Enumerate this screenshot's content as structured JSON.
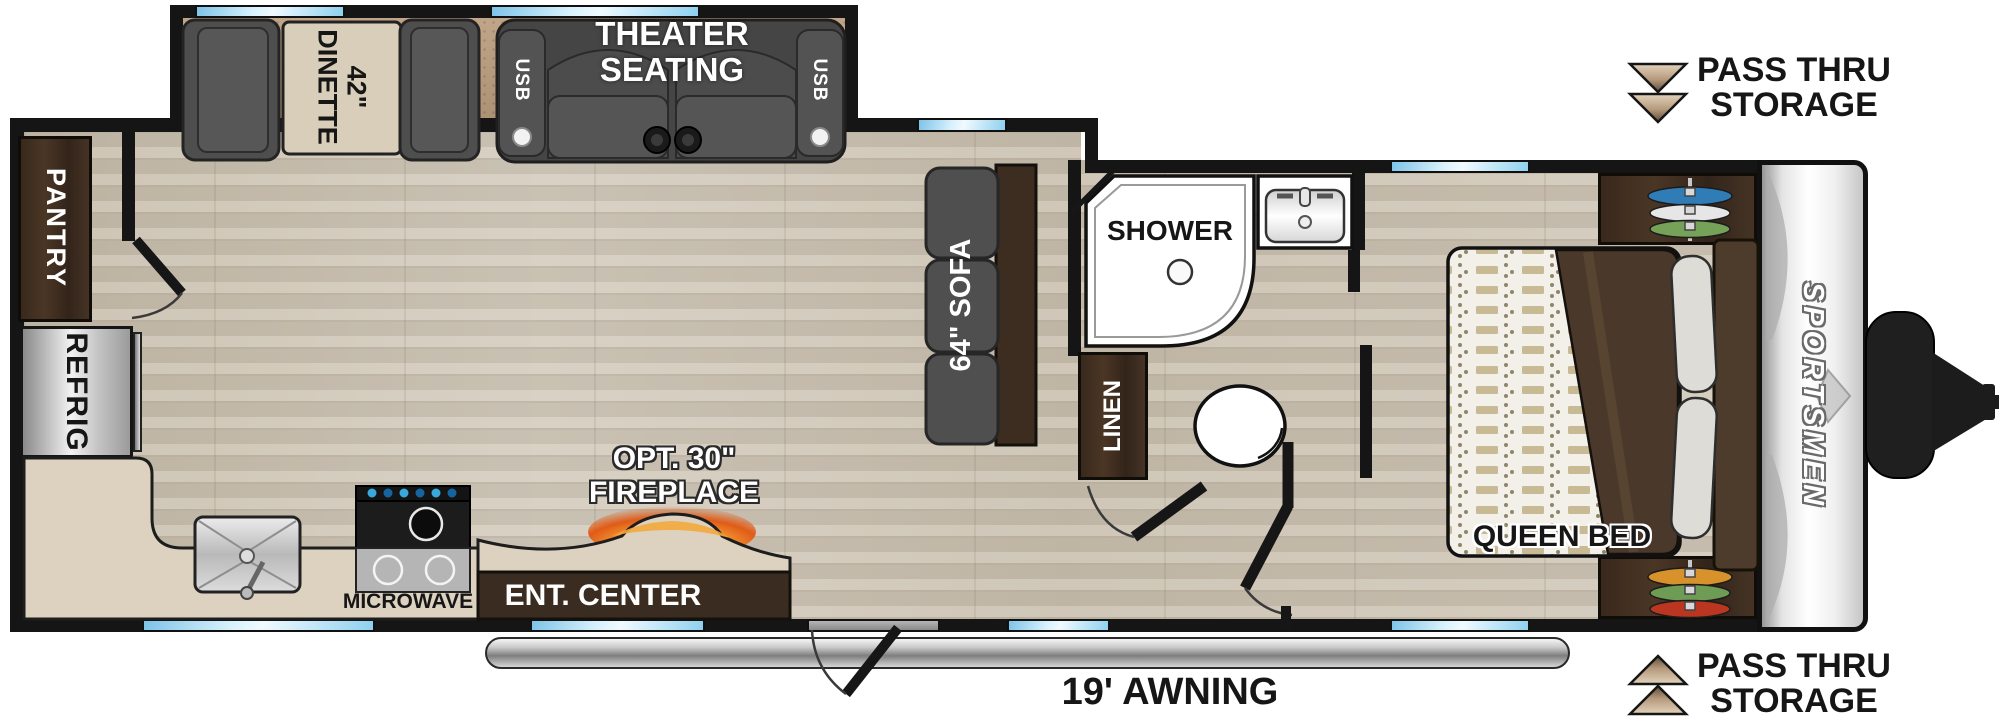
{
  "labels": {
    "dinette": "42\" DINETTE",
    "theater_line1": "THEATER",
    "theater_line2": "SEATING",
    "usb": "USB",
    "pantry": "PANTRY",
    "refrig": "REFRIG",
    "microwave": "MICROWAVE",
    "sofa": "64\" SOFA",
    "shower": "SHOWER",
    "linen": "LINEN",
    "queen_bed": "QUEEN BED",
    "ent_center": "ENT. CENTER",
    "fireplace_line1": "OPT. 30\"",
    "fireplace_line2": "FIREPLACE",
    "awning": "19' AWNING",
    "pass_thru_line1": "PASS THRU",
    "pass_thru_line2": "STORAGE",
    "brand_logo": "SPORTSMEN"
  },
  "icons": {
    "pass_thru_top": "double-chevron-down-icon",
    "pass_thru_bottom": "double-chevron-up-icon",
    "fireplace": "flame-glow-icon",
    "cupholders": "cupholder-circles-icon"
  },
  "colors": {
    "window_glass": "#8ed0ef",
    "wood_floor": "#cdc3b2",
    "slide_floor": "#b79c80",
    "counter": "#ddd2bf",
    "cabinet_dark": "#3a2c20",
    "furniture_gray": "#4e4e4e",
    "fireplace_glow": "#f59b2e",
    "awning_tube": "#9a9a9a",
    "wardrobe_top_hangers": [
      "#2f7cb6",
      "#e6e6e6",
      "#76a158"
    ],
    "wardrobe_bottom_hangers": [
      "#d8922c",
      "#6f9c55",
      "#bb3620"
    ]
  }
}
